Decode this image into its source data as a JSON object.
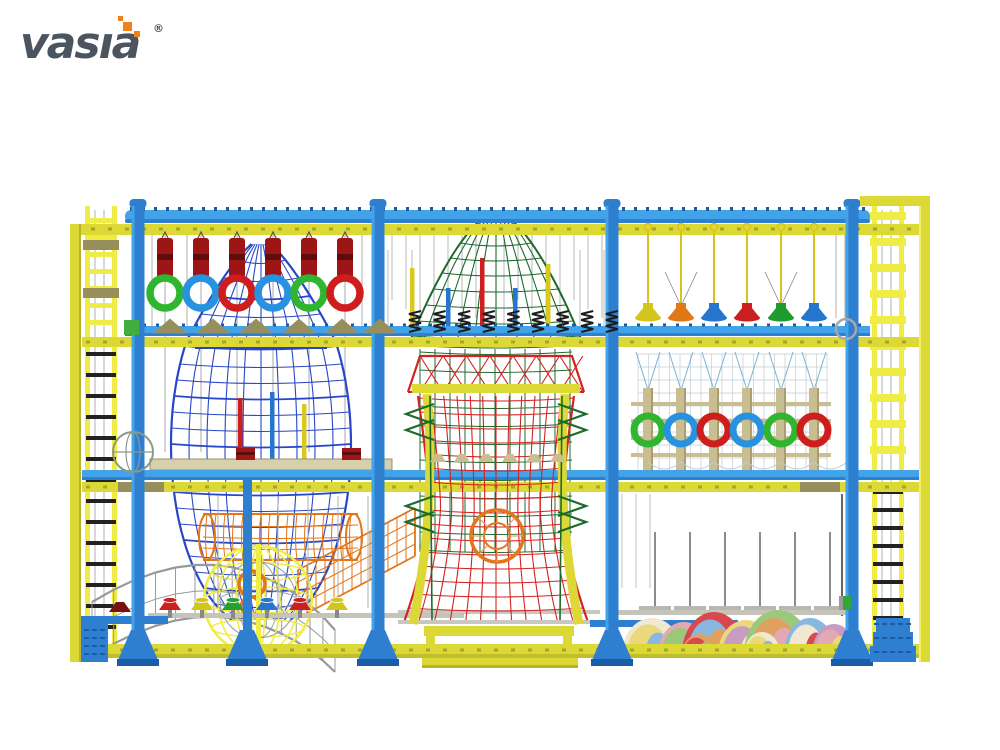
{
  "brand": {
    "name": "vasıa",
    "registered": "®"
  },
  "palette": {
    "background": "#ffffff",
    "logo_gray": "#4a5560",
    "logo_orange": "#f08018",
    "frame_blue": "#2f7fd1",
    "frame_blue_light": "#43a3e8",
    "frame_blue_dark": "#1a5ca6",
    "frame_yellow": "#dcd836",
    "frame_yellow_dark": "#a8a428",
    "ladder_yellow": "#f0ec46",
    "rocket_blue": "#2847c8",
    "dome_green": "#1d6b2b",
    "tower_red": "#d42222",
    "tunnel_orange": "#e2761a",
    "net_gray": "#969a9c",
    "net_light": "#c3ccd2",
    "rope_gray": "#a8a8a8",
    "rope_blue": "#7ab2d6",
    "tan": "#c9bd92",
    "tan_dark": "#9a9165",
    "platform_tan": "#d6d0ac",
    "olive": "#968f5c",
    "bag_red": "#9e1515",
    "bag_red_dark": "#5e0c0c",
    "spring_black": "#1c1c1c",
    "steel_gray": "#8f9598"
  },
  "equipment": {
    "punch_bag_row": {
      "count": 6,
      "color": "#9e1515"
    },
    "gym_ring_row": {
      "colors": [
        "#2fb52f",
        "#2792e0",
        "#cf1d1d",
        "#2792e0",
        "#2fb52f",
        "#cf1d1d"
      ]
    },
    "hanging_stepper_row": {
      "colors": [
        "#d4c41e",
        "#e07818",
        "#2676d0",
        "#cc1f1f",
        "#1f9c30",
        "#2676d0"
      ]
    },
    "climb_post_ring_row": {
      "colors": [
        "#2fb52f",
        "#2792e0",
        "#cf1d1d",
        "#2792e0",
        "#2fb52f",
        "#cf1d1d"
      ]
    },
    "floor_stepper_row": {
      "colors": [
        "#cc2020",
        "#d4c41e",
        "#28a030",
        "#2676d0",
        "#cc2020",
        "#d4c41e"
      ]
    },
    "dome_pole_colors": [
      "#d8c820",
      "#2676d0",
      "#cc1f1f",
      "#2676d0",
      "#d8c820"
    ],
    "triangle_step_row": {
      "count": 6,
      "color": "#968f5c"
    },
    "spring_row": {
      "count": 9,
      "color": "#1c1c1c"
    },
    "soft_mound_colors": [
      "#f0e8d0",
      "#e4a8b4",
      "#d84850",
      "#ecd87c",
      "#9cc87c",
      "#88b8e0",
      "#c89cc0",
      "#e0a060"
    ]
  }
}
